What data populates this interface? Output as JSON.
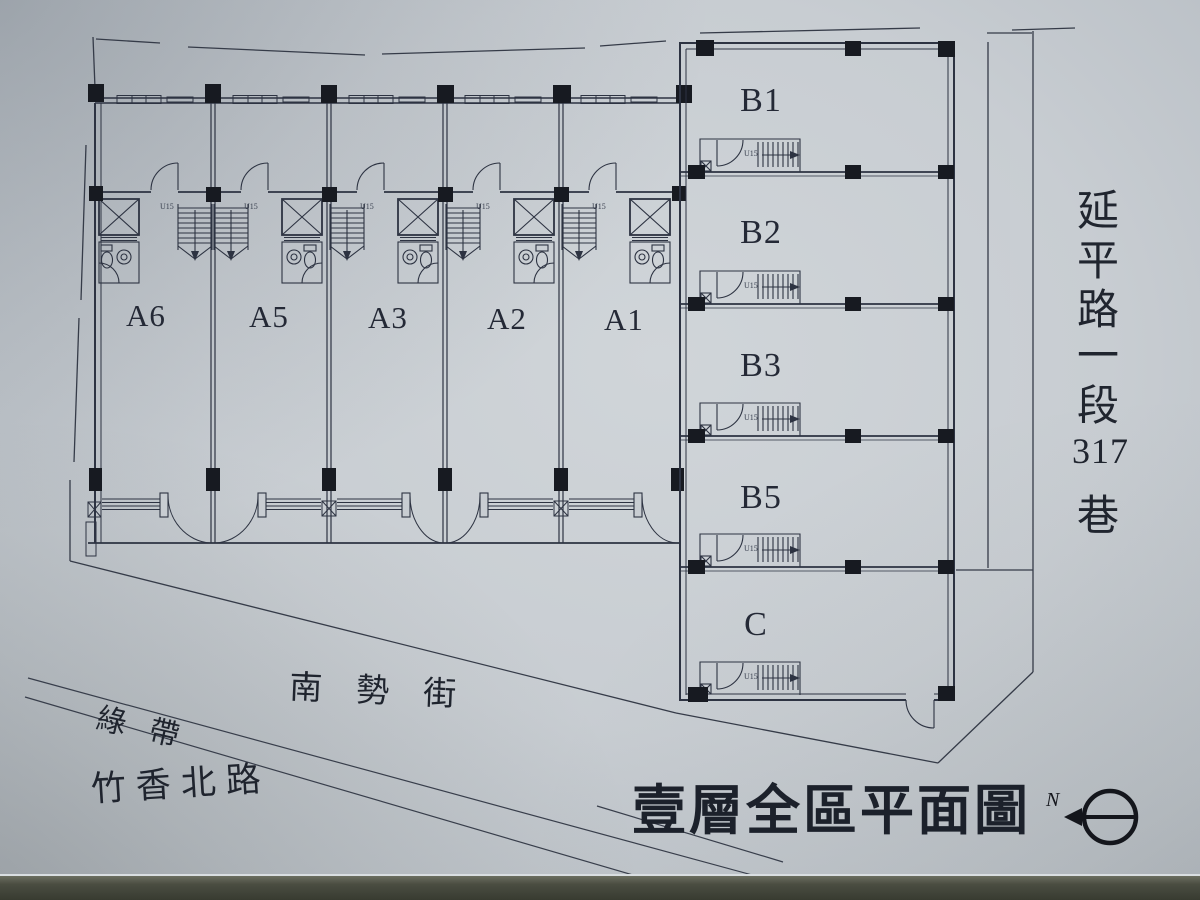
{
  "title": {
    "text": "壹層全區平面圖"
  },
  "north": {
    "label": "N"
  },
  "stairs": {
    "label": "U15"
  },
  "units": {
    "row_a": [
      {
        "label": "A6"
      },
      {
        "label": "A5"
      },
      {
        "label": "A3"
      },
      {
        "label": "A2"
      },
      {
        "label": "A1"
      }
    ],
    "column_b": [
      {
        "label": "B1"
      },
      {
        "label": "B2"
      },
      {
        "label": "B3"
      },
      {
        "label": "B5"
      },
      {
        "label": "C"
      }
    ]
  },
  "streets": {
    "east_lane": "延平路一段317巷",
    "east_lane_chars": [
      "延",
      "平",
      "路",
      "一",
      "段",
      "317",
      "巷"
    ],
    "south_street": "南勢街",
    "green_belt": "綠帶",
    "southwest_road": "竹香北路"
  },
  "colors": {
    "paper": "#c8cdd2",
    "ink": "#2d3342",
    "column_fill": "#171a21",
    "photo_edge": "#4a4d41"
  }
}
